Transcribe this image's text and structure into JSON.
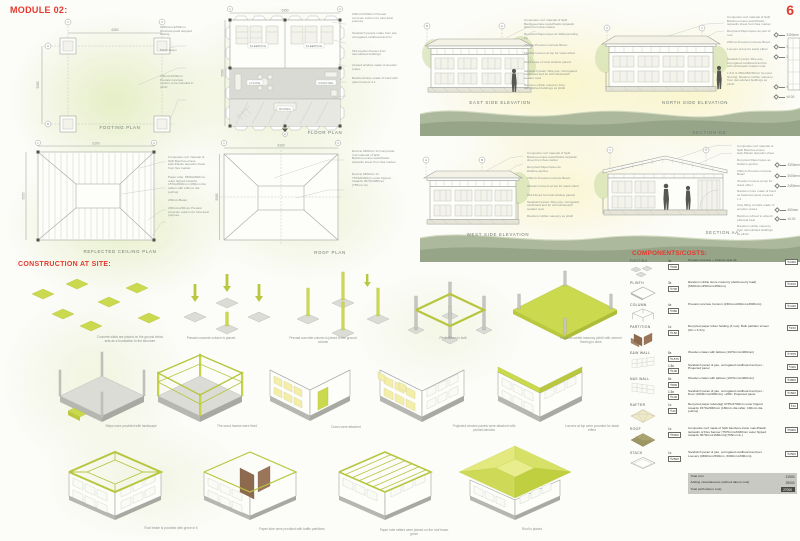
{
  "page": {
    "title": "MODULE 02:",
    "page_number": "6"
  },
  "headings": {
    "construction": "CONSTRUCTION AT SITE:",
    "components": "COMPONENTS/COSTS:"
  },
  "colors": {
    "accent_red": "#e4392e",
    "lime": "#cbd94e",
    "sage_ground": "#9aa88c",
    "crate_yellow": "#f3efa9",
    "partition_brown": "#8d6a4e",
    "roof_olive": "#9d9663"
  },
  "bubbles": {
    "n1": "1",
    "n2": "2",
    "a": "A",
    "b": "B"
  },
  "plans": {
    "footing": {
      "label": "FOOTING PLAN",
      "dim_w": "6350",
      "dim_h": "5080",
      "callouts": [
        "1200mmx1200mm Concrete pads stepped footing",
        "Plinth Beam",
        "230mmX230mm Precast concrete column to be included in plinth"
      ]
    },
    "floor": {
      "label": "FLOOR PLAN",
      "dim_w": "6350",
      "dim_h": "5080",
      "rooms": [
        "SLEEPING",
        "SLEEPING",
        "LIVING",
        "COOKING",
        "DINING"
      ],
      "callouts": [
        "230mmX230mm Precast concrete column for structural purpose",
        "Sandwich panels made from jute corrugated cardboard and tin",
        "Old wooden frames from demolished buildings",
        "pivoted window made of wooden crates",
        "Bamboo/Cane made of Card with panel louvers 1:1"
      ]
    },
    "rcp": {
      "label": "REFLECTED CEILING  PLAN",
      "dim_w": "6100",
      "dim_h": "5050",
      "callouts": [
        "Composite roof material of Split Bamboo+Cane leaf+Plastic tarpaulin sheet from flea market",
        "Paper tube: 5830x2840mm outer hipped towards 1570x2840mm (180mm dia rafters with 100mm dia purlins)",
        "230mm Beam",
        "230mmx230mm Precast concrete column for structural purpose"
      ]
    },
    "roof": {
      "label": "ROOF PLAN",
      "dim_w": "6330",
      "dim_h": "5080",
      "callouts": [
        "Roof at 3300mm lvl Composite roof material of Split Bamboo+Cane leaf+Plastic tarpaulin sheet from flea market",
        "Roof at 3300mm lvl 7570x6330mm outer hipped towards 3070x1660mm (765mm tk)"
      ]
    }
  },
  "elevations": {
    "east": {
      "label": "EAST SIDE ELEVATION",
      "callouts": [
        "Composite roof material of Split Bamboo+Cane leaf+Plastic tarpaulin sheet from flea market",
        "Recycled Paperropes as Waterproofing ply",
        "230mm Precast concrete Beam",
        "Flexible louvers at top for stack effect",
        "Old frames or local window panels",
        "Sandwich panel: Rice jute, Corrugated cardboard and tin with whitewash sealant coat",
        "Random rubble masonry from demolished buildings as plinth"
      ]
    },
    "north": {
      "label": "NORTH SIDE ELEVATION",
      "levels": [
        "3300mm",
        "3000mm",
        "2450mm",
        "450mm",
        "±0.00"
      ],
      "callouts": [
        "Composite roof material of Split Bamboo+Cane leaf+Plastic tarpaulin sheet from flea market",
        "Recycled Paperropes as part of roof",
        "230mm Precast concrete Beam",
        "Louvers at top for stack effect",
        "Sandwich panel: Rice jute, corrugated cardboard and tin with whitewash sealant coat",
        "1:4:8 of 450x450x50mm Cement flooring; Random rubble masonry from demolished buildings as plinth"
      ]
    },
    "west": {
      "label": "WEST SIDE ELEVATION",
      "callouts": [
        "Composite roof material of Split Bamboo+Cane leaf+Plastic tarpaulin sheet from flea market",
        "Recycled Paperropes as Rafters+purlins",
        "230mm Precast concrete Beam",
        "Wooden louvers at top for stack effect",
        "Old frames for local window panels",
        "Sandwich panel: Rice jute, corrugated cardboard and tin with whitewash sealant coat",
        "Random rubble masonry as plinth"
      ]
    },
    "section_bb_label": "SECTION-BB'",
    "section_aa": {
      "label": "SECTION AA'",
      "levels": [
        "3300mm",
        "3000mm",
        "2450mm",
        "450mm",
        "±0.00"
      ],
      "callouts": [
        "Composite roof material of Split Bamboo+Cane leaf+Plastic tarpaulin sheet",
        "Recycled Paperropes as Rafters+purlins",
        "230mm Precast concrete Beam",
        "Wooden louvers at top for stack effect",
        "Random Core made of Card as backrest panel covered 1:1",
        "Clay filling of walls made of wooden crates",
        "Bamboo refined to absorb ethereal heat",
        "Random rubble masonry from demolished buildings as plinth"
      ]
    }
  },
  "construction": {
    "steps": [
      "Concrete slabs are placed on the ground which acts as a foundation to the structure",
      "Precast concrete column is placed",
      "Precast concrete column is joined to the ground column",
      "Plinth Beam is built",
      "Random rubble masonry plinth with cement flooring is done",
      "Steps were provided with landscape",
      "The wood frames were fixed",
      "Doors were attached",
      "Projected window panels were attached with pivoted window",
      "Louvers at top were provided for stack effect",
      "Roof beam is provided with grove in it",
      "Paper tube were provided with baffle partitions",
      "Paper tube rafters were placed on the roof beam grove",
      "Roof is placed"
    ]
  },
  "components": {
    "items": [
      {
        "part": "FOOTING",
        "rows": [
          {
            "qty": "4x",
            "unit": "₹600",
            "desc": "Precast concrete + Column upto GL",
            "total": "₹2400"
          }
        ]
      },
      {
        "part": "PLINTH",
        "rows": [
          {
            "qty": "3x",
            "unit": "₹700",
            "desc": "Random rubble stone masonry (debris+lorry load) (5400mmx450mmx450mm)",
            "total": "₹2100"
          }
        ]
      },
      {
        "part": "COLUMN",
        "rows": [
          {
            "qty": "4x",
            "unit": "₹360",
            "desc": "Precast concrete Column (230mmx200mmx3000mm)",
            "total": "₹1440"
          }
        ]
      },
      {
        "part": "PARTITION",
        "rows": [
          {
            "qty": "1x",
            "unit": "₹150",
            "desc": "Recycled paper tubes holding (3 nos); Bulk partition screen (9m x 3.3m)",
            "total": "₹150"
          }
        ]
      },
      {
        "part": "E&W WALL",
        "rows": [
          {
            "qty": "5x",
            "unit": "₹1575",
            "desc": "Wooden crates with lattices (1970mmx1900mm)",
            "total": "₹7875"
          },
          {
            "qty": "1.5x",
            "unit": "₹100",
            "desc": "Sandwich panel of jute, corrugated cardboard and pet -Projected panel",
            "total": "₹300"
          }
        ]
      },
      {
        "part": "N&S WALL",
        "rows": [
          {
            "qty": "6x",
            "unit": "₹800",
            "desc": "Wooden crates with lattices (1970mmx1900mm)",
            "total": "₹4800"
          },
          {
            "qty": "1.5x",
            "unit": "₹100",
            "desc": "Sandwich panel of jute, corrugated cardboard and pet -Door (1000mmx2000mm) +200/- Projected panel",
            "total": "₹1500"
          }
        ]
      },
      {
        "part": "RAFTER",
        "rows": [
          {
            "qty": "1x",
            "unit": "₹40",
            "desc": "Recycled paper tubes(kg) 6745x3790mm outer hipped towards 1570x2840mm (180mm dia rafter, 100mm dia purlins)",
            "total": "₹40"
          }
        ]
      },
      {
        "part": "ROOF",
        "rows": [
          {
            "qty": "1x",
            "unit": "₹5000",
            "desc": "Composite roof made of Split bamboo+Cane mat+Plastic tarpaulin of Flex banner (7570mmx6330mm outer hipped towards 3070mmx1660mm)(765mm tk.)",
            "total": "₹5000"
          }
        ]
      },
      {
        "part": "STACK",
        "rows": [
          {
            "qty": "1x",
            "unit": "₹2500",
            "desc": "Sandwich panel of jute, corrugated cardboard and pet Louvers (4690mmx500mm, 6000mmx500mm)",
            "total": "₹2500"
          }
        ]
      }
    ],
    "totals": [
      {
        "label": "Total cost",
        "value": "21900"
      },
      {
        "label": "Adding miscellaneous (without labour cost)",
        "value": "25000"
      },
      {
        "label": "Total (with labour cost)",
        "value": "27000"
      }
    ]
  }
}
